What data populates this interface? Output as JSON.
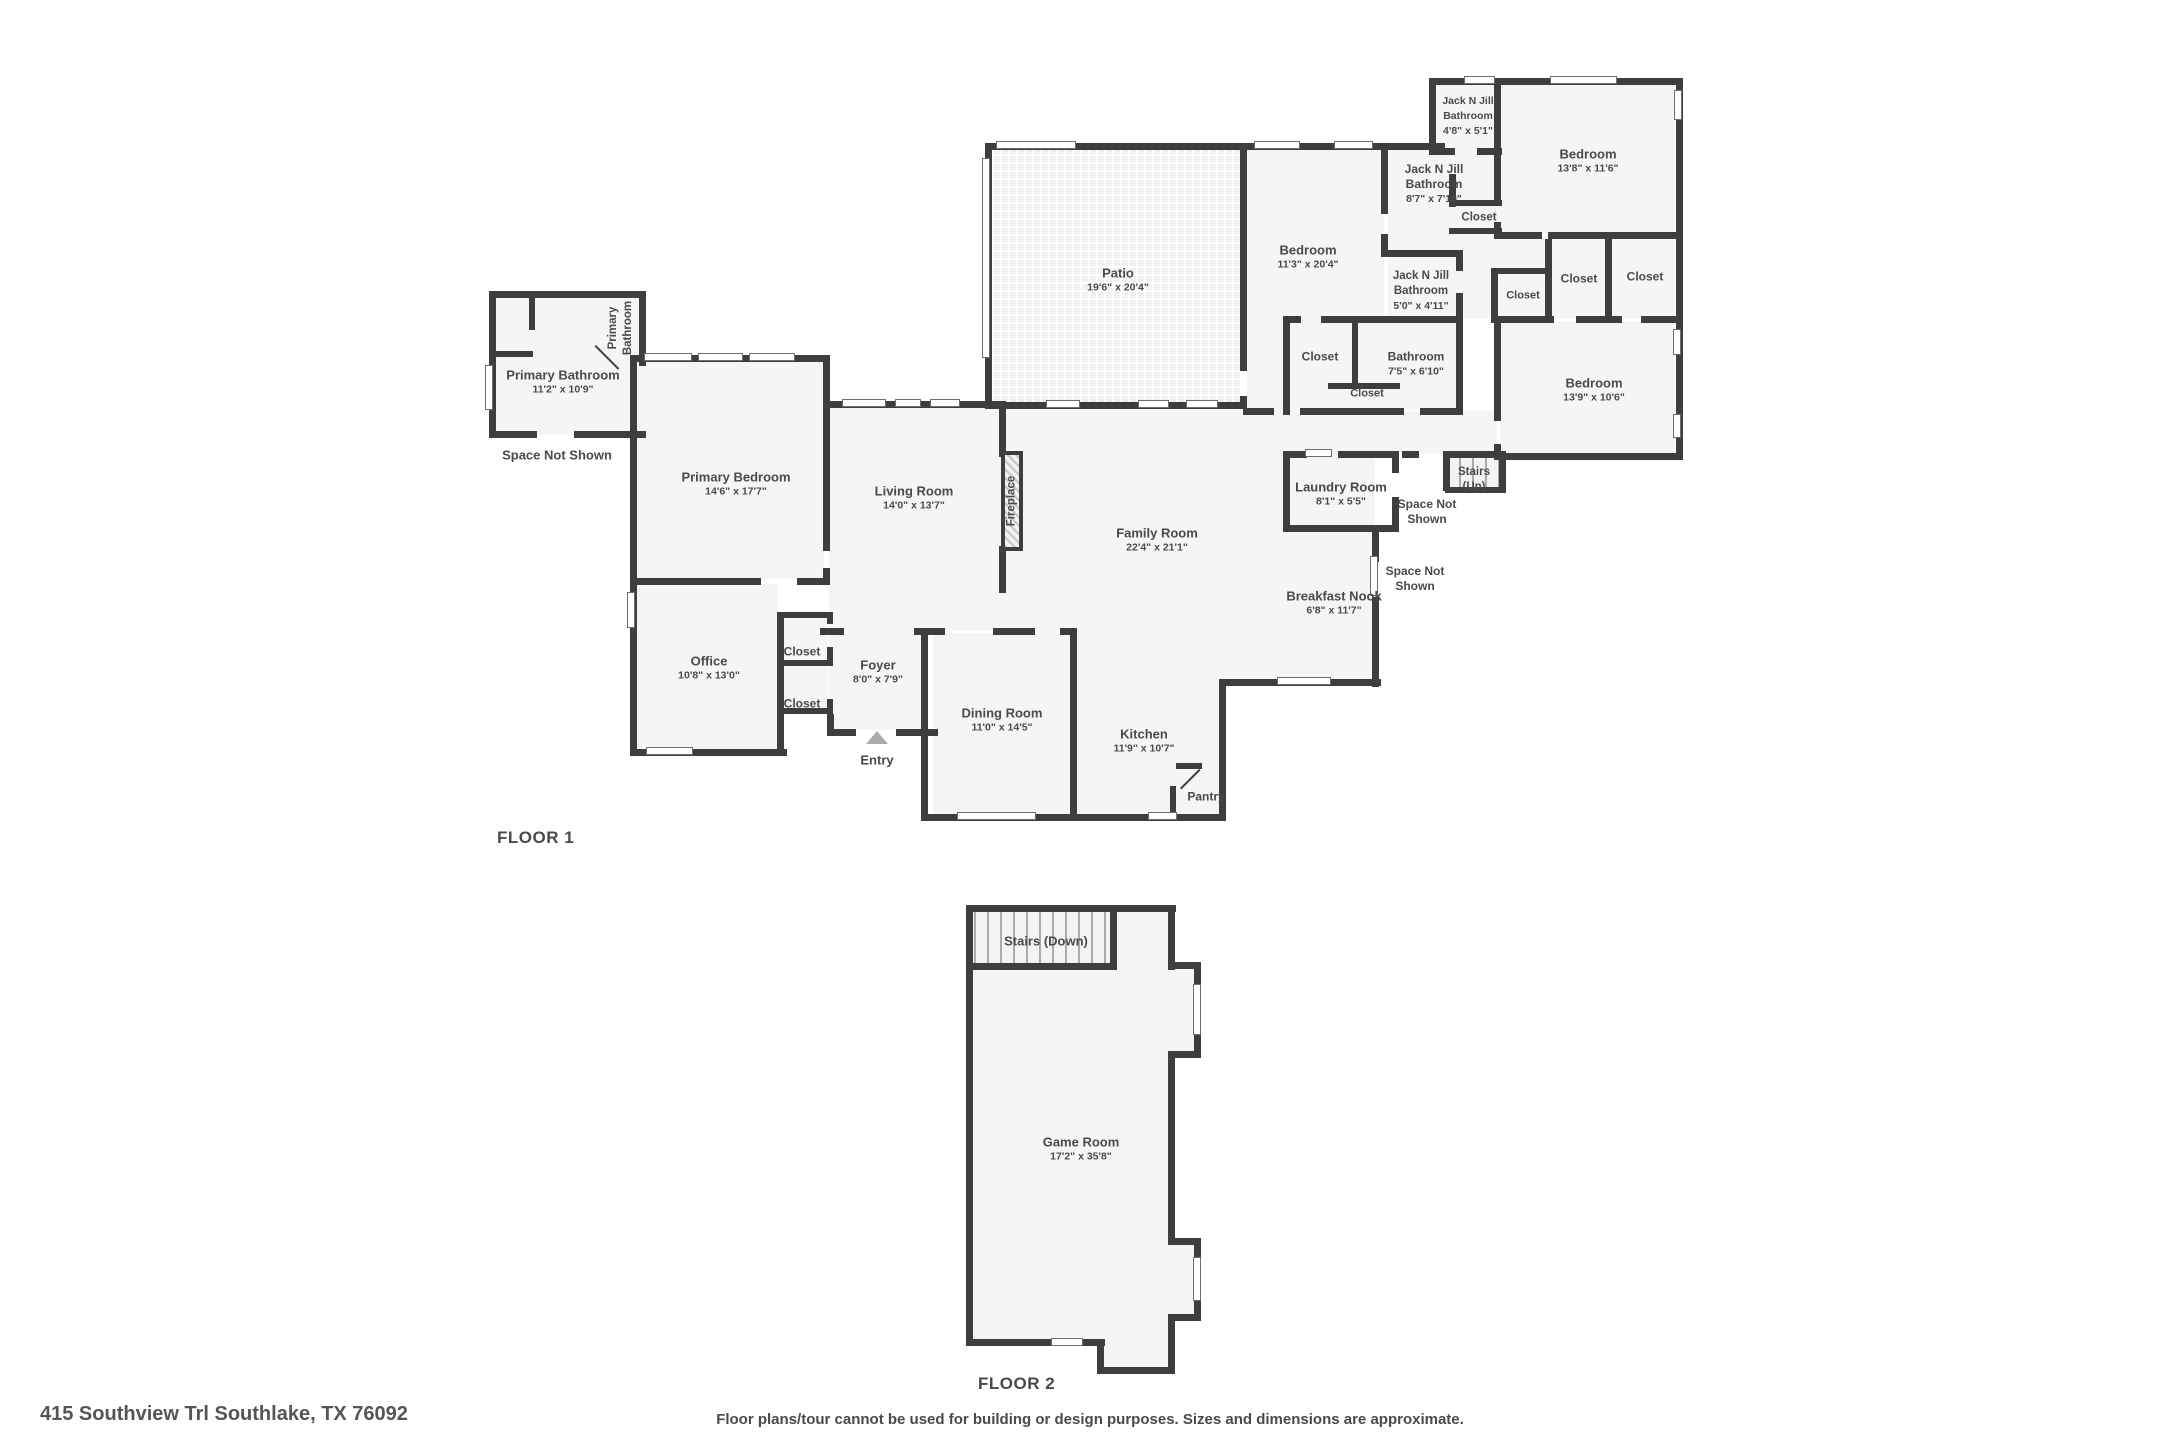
{
  "meta": {
    "type": "floor-plan",
    "colors": {
      "wall": "#3e3e3e",
      "room_fill": "#f5f5f5",
      "label": "#4a4a4a",
      "entry_arrow": "#ababab"
    }
  },
  "footer": {
    "address": "415 Southview Trl Southlake, TX 76092",
    "disclaimer": "Floor plans/tour cannot be used for building or design purposes. Sizes and dimensions are approximate."
  },
  "floors": [
    {
      "title": "FLOOR 1",
      "title_pos": {
        "x": 497,
        "y": 828
      },
      "labels": [
        {
          "text": "Primary Bathroom",
          "dims": "11'2\" x 10'9\"",
          "x": 563,
          "y": 382,
          "w": 130
        },
        {
          "text": "Primary Bathroom",
          "x": 621,
          "y": 328,
          "w": 86,
          "rot": true,
          "fs": 11.5
        },
        {
          "text": "Space Not Shown",
          "x": 557,
          "y": 455,
          "w": 110
        },
        {
          "text": "Primary Bedroom",
          "dims": "14'6\" x 17'7\"",
          "x": 736,
          "y": 484,
          "w": 170
        },
        {
          "text": "Office",
          "dims": "10'8\" x 13'0\"",
          "x": 709,
          "y": 668,
          "w": 110
        },
        {
          "text": "Closet",
          "x": 802,
          "y": 652,
          "w": 70,
          "fs": 12
        },
        {
          "text": "Closet",
          "x": 802,
          "y": 704,
          "w": 70,
          "fs": 12
        },
        {
          "text": "Foyer",
          "dims": "8'0\" x 7'9\"",
          "x": 878,
          "y": 672,
          "w": 90
        },
        {
          "text": "Entry",
          "x": 877,
          "y": 760,
          "w": 70
        },
        {
          "text": "Dining Room",
          "dims": "11'0\" x 14'5\"",
          "x": 1002,
          "y": 720,
          "w": 130
        },
        {
          "text": "Kitchen",
          "dims": "11'9\" x 10'7\"",
          "x": 1144,
          "y": 741,
          "w": 110
        },
        {
          "text": "Pantry",
          "x": 1206,
          "y": 797,
          "w": 70,
          "fs": 12
        },
        {
          "text": "Living Room",
          "dims": "14'0\" x 13'7\"",
          "x": 914,
          "y": 498,
          "w": 130
        },
        {
          "text": "Fireplace",
          "x": 1012,
          "y": 501,
          "w": 90,
          "rot": true,
          "fs": 11.5
        },
        {
          "text": "Family Room",
          "dims": "22'4\" x 21'1\"",
          "x": 1157,
          "y": 540,
          "w": 130
        },
        {
          "text": "Patio",
          "dims": "19'6\" x 20'4\"",
          "x": 1118,
          "y": 280,
          "w": 110
        },
        {
          "text": "Bedroom",
          "dims": "11'3\" x 20'4\"",
          "x": 1308,
          "y": 257,
          "w": 110
        },
        {
          "text": "Jack N Jill Bathroom",
          "dims": "8'7\" x 7'10\"",
          "x": 1434,
          "y": 184,
          "w": 104,
          "fs": 12
        },
        {
          "text": "Closet",
          "x": 1479,
          "y": 218,
          "w": 70,
          "fs": 11.5
        },
        {
          "text": "Jack N Jill Bathroom",
          "dims": "4'8\" x 5'1\"",
          "x": 1468,
          "y": 116,
          "w": 88,
          "fs": 10.5
        },
        {
          "text": "Bedroom",
          "dims": "13'8\" x 11'6\"",
          "x": 1588,
          "y": 161,
          "w": 110
        },
        {
          "text": "Closet",
          "x": 1523,
          "y": 296,
          "w": 60,
          "fs": 11
        },
        {
          "text": "Closet",
          "x": 1579,
          "y": 279,
          "w": 70,
          "fs": 12
        },
        {
          "text": "Closet",
          "x": 1645,
          "y": 277,
          "w": 70,
          "fs": 12
        },
        {
          "text": "Jack N Jill Bathroom",
          "dims": "5'0\" x 4'11\"",
          "x": 1421,
          "y": 291,
          "w": 100,
          "fs": 11.5
        },
        {
          "text": "Bathroom",
          "dims": "7'5\" x 6'10\"",
          "x": 1416,
          "y": 364,
          "w": 100,
          "fs": 12
        },
        {
          "text": "Closet",
          "x": 1320,
          "y": 357,
          "w": 70,
          "fs": 12
        },
        {
          "text": "Closet",
          "x": 1367,
          "y": 394,
          "w": 70,
          "fs": 11
        },
        {
          "text": "Bedroom",
          "dims": "13'9\" x 10'6\"",
          "x": 1594,
          "y": 390,
          "w": 110
        },
        {
          "text": "Laundry Room",
          "dims": "8'1\" x 5'5\"",
          "x": 1341,
          "y": 494,
          "w": 130
        },
        {
          "text": "Stairs (Up)",
          "x": 1474,
          "y": 480,
          "w": 58,
          "fs": 11.5
        },
        {
          "text": "Space Not Shown",
          "x": 1427,
          "y": 512,
          "w": 100,
          "fs": 12
        },
        {
          "text": "Space Not Shown",
          "x": 1415,
          "y": 579,
          "w": 100,
          "fs": 12
        },
        {
          "text": "Breakfast Nook",
          "dims": "6'8\" x 11'7\"",
          "x": 1334,
          "y": 603,
          "w": 150
        }
      ]
    },
    {
      "title": "FLOOR 2",
      "title_pos": {
        "x": 978,
        "y": 1374
      },
      "labels": [
        {
          "text": "Stairs (Down)",
          "x": 1046,
          "y": 941,
          "w": 150
        },
        {
          "text": "Game Room",
          "dims": "17'2\" x 35'8\"",
          "x": 1081,
          "y": 1149,
          "w": 130
        }
      ]
    }
  ]
}
